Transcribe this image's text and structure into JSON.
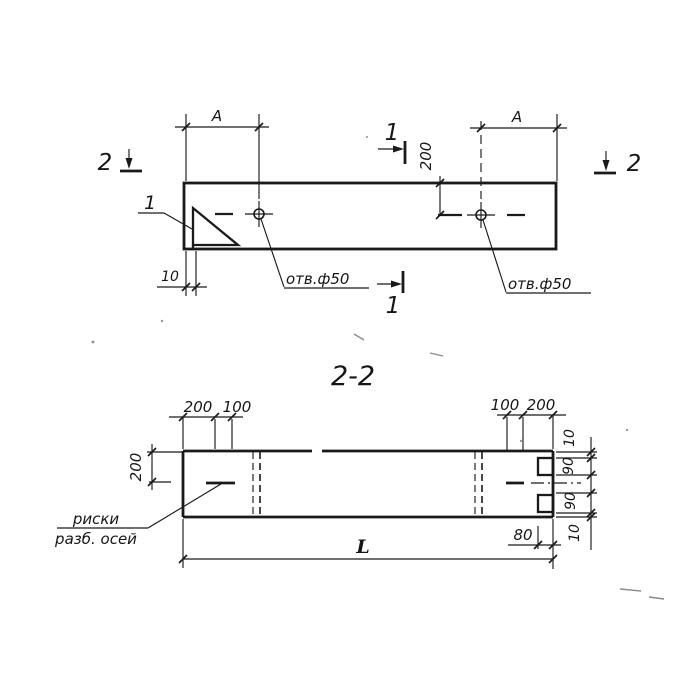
{
  "drawing": {
    "section_title": "2-2",
    "top_view": {
      "dim_a_left": "A",
      "dim_a_right": "A",
      "dim_hole_offset": "200",
      "dim_chamfer": "10",
      "hole_label_left": "отв.ф50",
      "hole_label_right": "отв.ф50",
      "detail_mark": "1",
      "section_1_top": "1",
      "section_1_bottom": "1",
      "section_2_left": "2",
      "section_2_right": "2"
    },
    "section_view": {
      "dim_left_200": "200",
      "dim_left_100": "100",
      "dim_right_100": "100",
      "dim_right_200": "200",
      "dim_width_half": "200",
      "dim_edge_10_top": "10",
      "dim_notch_90_top": "90",
      "dim_notch_90_bottom": "90",
      "dim_edge_10_bottom": "10",
      "dim_notch_depth": "80",
      "dim_length": "L",
      "axes_note_line1": "риски",
      "axes_note_line2": "разб. осей"
    },
    "colors": {
      "ink": "#1a1a1a",
      "paper": "#ffffff"
    }
  }
}
